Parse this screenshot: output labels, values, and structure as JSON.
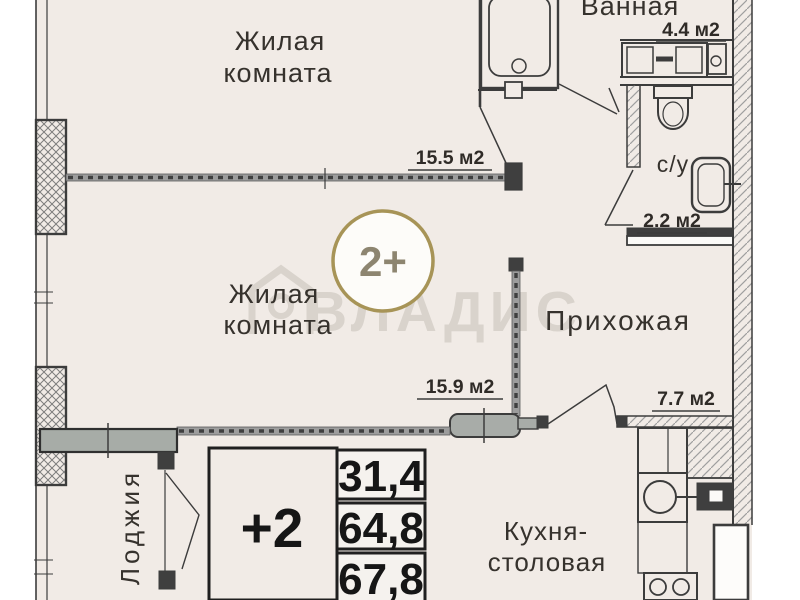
{
  "colors": {
    "page": "#ffffff",
    "floor": "#f1ebe6",
    "line": "#3c3c3c",
    "wall_gray": "#a7aca7",
    "badge_ring": "#a79457",
    "badge_text": "#8d8570",
    "watermark": "#d9d3cc"
  },
  "rooms": {
    "living1": {
      "label1": "Жилая",
      "label2": "комната",
      "area": "15.5 м2"
    },
    "living2": {
      "label1": "Жилая",
      "label2": "комната",
      "area": "15.9 м2"
    },
    "bathroom": {
      "label": "Ванная",
      "area": "4.4 м2"
    },
    "wc": {
      "label": "с/у",
      "area": "2.2 м2"
    },
    "hallway": {
      "label": "Прихожая",
      "area": "7.7 м2"
    },
    "kitchen": {
      "label1": "Кухня-",
      "label2": "столовая"
    },
    "loggia": {
      "label": "Лоджия"
    }
  },
  "badge": {
    "label": "2+"
  },
  "stamp": {
    "label": "+2",
    "values": [
      "31,4",
      "64,8",
      "67,8"
    ]
  },
  "watermark": {
    "text": "ВЛАДИС"
  }
}
